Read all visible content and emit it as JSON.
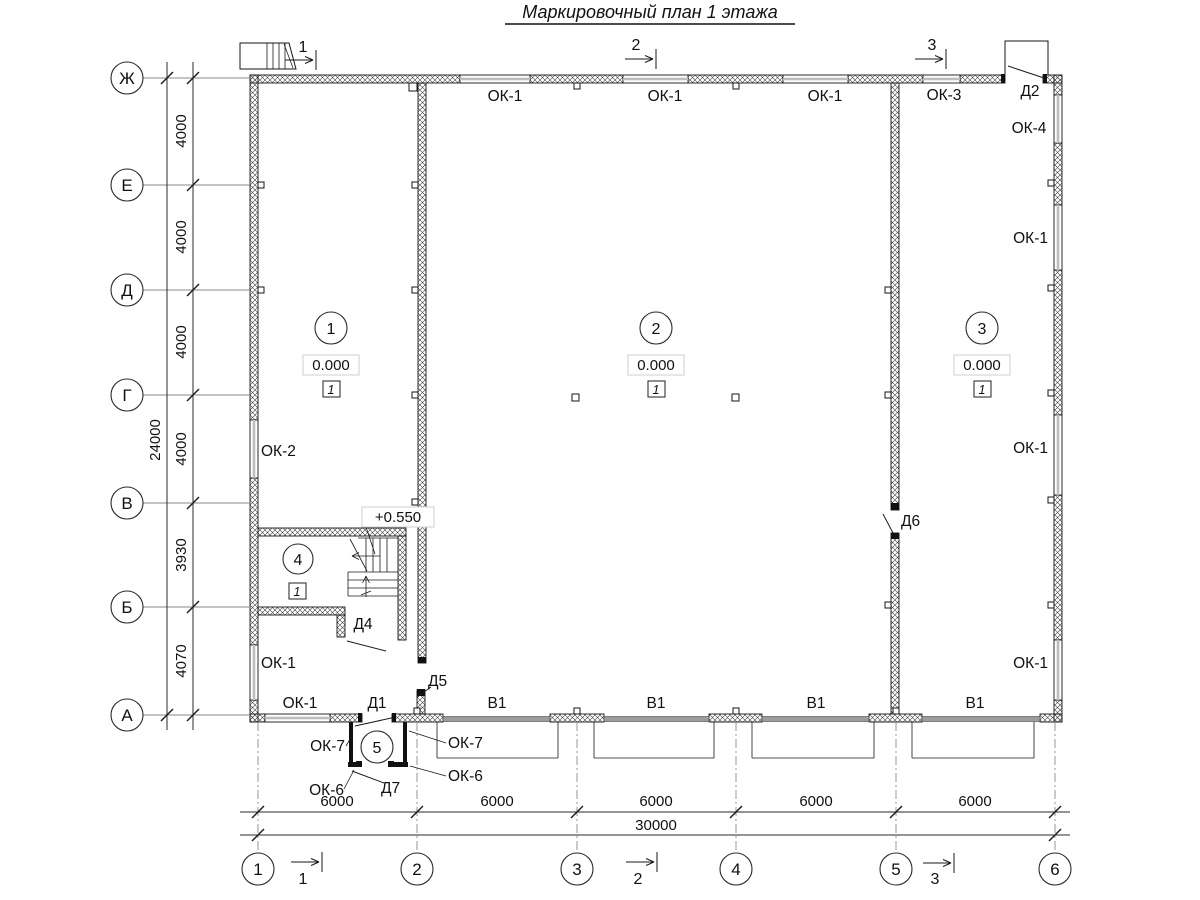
{
  "title": "Маркировочный план 1 этажа",
  "row_axes": [
    {
      "label": "Ж"
    },
    {
      "label": "Е"
    },
    {
      "label": "Д"
    },
    {
      "label": "Г"
    },
    {
      "label": "В"
    },
    {
      "label": "Б"
    },
    {
      "label": "А"
    }
  ],
  "row_dims": [
    "4000",
    "4000",
    "4000",
    "4000",
    "3930",
    "4070"
  ],
  "row_total": "24000",
  "col_axes": [
    {
      "label": "1"
    },
    {
      "label": "2"
    },
    {
      "label": "3"
    },
    {
      "label": "4"
    },
    {
      "label": "5"
    },
    {
      "label": "6"
    }
  ],
  "col_dims": [
    "6000",
    "6000",
    "6000",
    "6000",
    "6000"
  ],
  "col_total": "30000",
  "sections": {
    "top": [
      "1",
      "2",
      "3"
    ],
    "bottom": [
      "1",
      "2",
      "3"
    ]
  },
  "rooms": [
    {
      "number": "1",
      "elevation": "0.000",
      "finish": "1"
    },
    {
      "number": "2",
      "elevation": "0.000",
      "finish": "1"
    },
    {
      "number": "3",
      "elevation": "0.000",
      "finish": "1"
    },
    {
      "number": "4",
      "finish": "1"
    },
    {
      "number": "5"
    }
  ],
  "stair_elevation": "+0.550",
  "openings": {
    "top_windows": [
      "ОК-1",
      "ОК-1",
      "ОК-1",
      "ОК-3"
    ],
    "right_windows": [
      "ОК-4",
      "ОК-1",
      "ОК-1",
      "ОК-1"
    ],
    "left_windows": [
      "ОК-2",
      "ОК-1"
    ],
    "bottom_window": "ОК-1",
    "doors": {
      "d1": "Д1",
      "d2": "Д2",
      "d4": "Д4",
      "d5": "Д5",
      "d6": "Д6",
      "d7": "Д7"
    },
    "gates": [
      "В1",
      "В1",
      "В1",
      "В1"
    ],
    "vestibule_windows": {
      "ok7_left": "ОК-7",
      "ok7_right": "ОК-7",
      "ok6_left": "ОК-6",
      "ok6_right": "ОК-6"
    }
  },
  "colors": {
    "wall_line": "#151515",
    "window_fill": "#bdbdbd",
    "gate_fill": "#9c9c9c",
    "axis_line": "#8a8a8a"
  }
}
